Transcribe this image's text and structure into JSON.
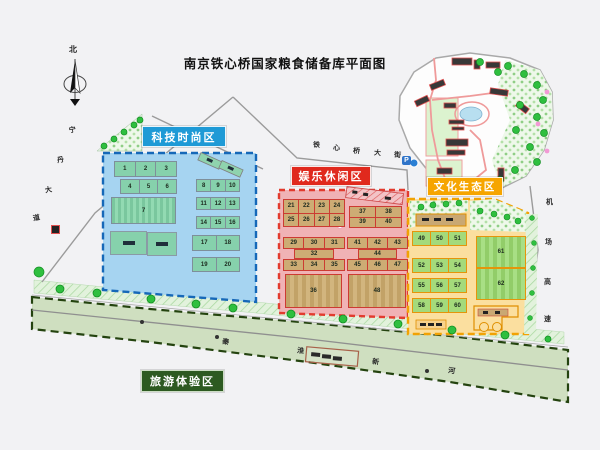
{
  "title": "南京铁心桥国家粮食储备库平面图",
  "compass": {
    "north_label": "北"
  },
  "zones": {
    "tech": {
      "label": "科技时尚区",
      "color": "#1e9ad6",
      "blocks": [
        "1",
        "2",
        "3",
        "4",
        "5",
        "6",
        "7",
        "8",
        "9",
        "10",
        "11",
        "12",
        "13",
        "14",
        "15",
        "16",
        "17",
        "18",
        "19",
        "20"
      ]
    },
    "fun": {
      "label": "娱乐休闲区",
      "color": "#e0291d",
      "blocks": [
        "21",
        "22",
        "23",
        "24",
        "25",
        "26",
        "27",
        "28",
        "29",
        "30",
        "31",
        "32",
        "33",
        "34",
        "35",
        "36",
        "37",
        "38",
        "39",
        "40",
        "41",
        "42",
        "43",
        "44",
        "45",
        "46",
        "47",
        "48"
      ]
    },
    "culture": {
      "label": "文化生态区",
      "color": "#f6a500",
      "blocks": [
        "49",
        "50",
        "51",
        "52",
        "53",
        "54",
        "55",
        "56",
        "57",
        "58",
        "59",
        "60",
        "61",
        "62"
      ]
    },
    "tourism": {
      "label": "旅游体验区",
      "color": "#2d5a21"
    }
  },
  "roads": {
    "west": "宁丹大道",
    "north": "铁心桥大街",
    "east": "机场高速",
    "river": "秦淮新河"
  },
  "icons": {
    "parking": "P"
  }
}
